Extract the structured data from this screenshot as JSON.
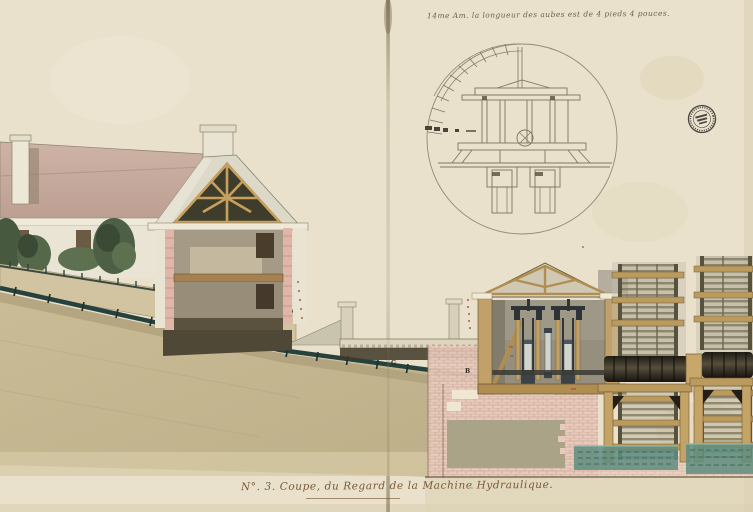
{
  "document": {
    "top_note": "14me Am.  la longueur des aubes est de 4 pieds 4 pouces.",
    "caption": "N°. 3. Coupe, du Regard de la Machine Hydraulique.",
    "reference_letters": {
      "g": "G",
      "b": "B"
    }
  },
  "icons": {
    "stamp": "circular-collection-stamp"
  },
  "palette": {
    "paper": "#e9e1cc",
    "roof_mauve": "#c3a598",
    "roof_gray": "#dcd9c8",
    "timber_tan": "#c79f5e",
    "attic_dark": "#3e3c2a",
    "ground_tan": "#c5b791",
    "brick_pink": "#e7cabb",
    "pipe_teal": "#27413d",
    "water_teal": "#5f8d7f",
    "machinery_slate": "#2e3338",
    "pencil": "#918a74",
    "ink": "#5a4a36",
    "foliage_green": "#4d5f44"
  }
}
